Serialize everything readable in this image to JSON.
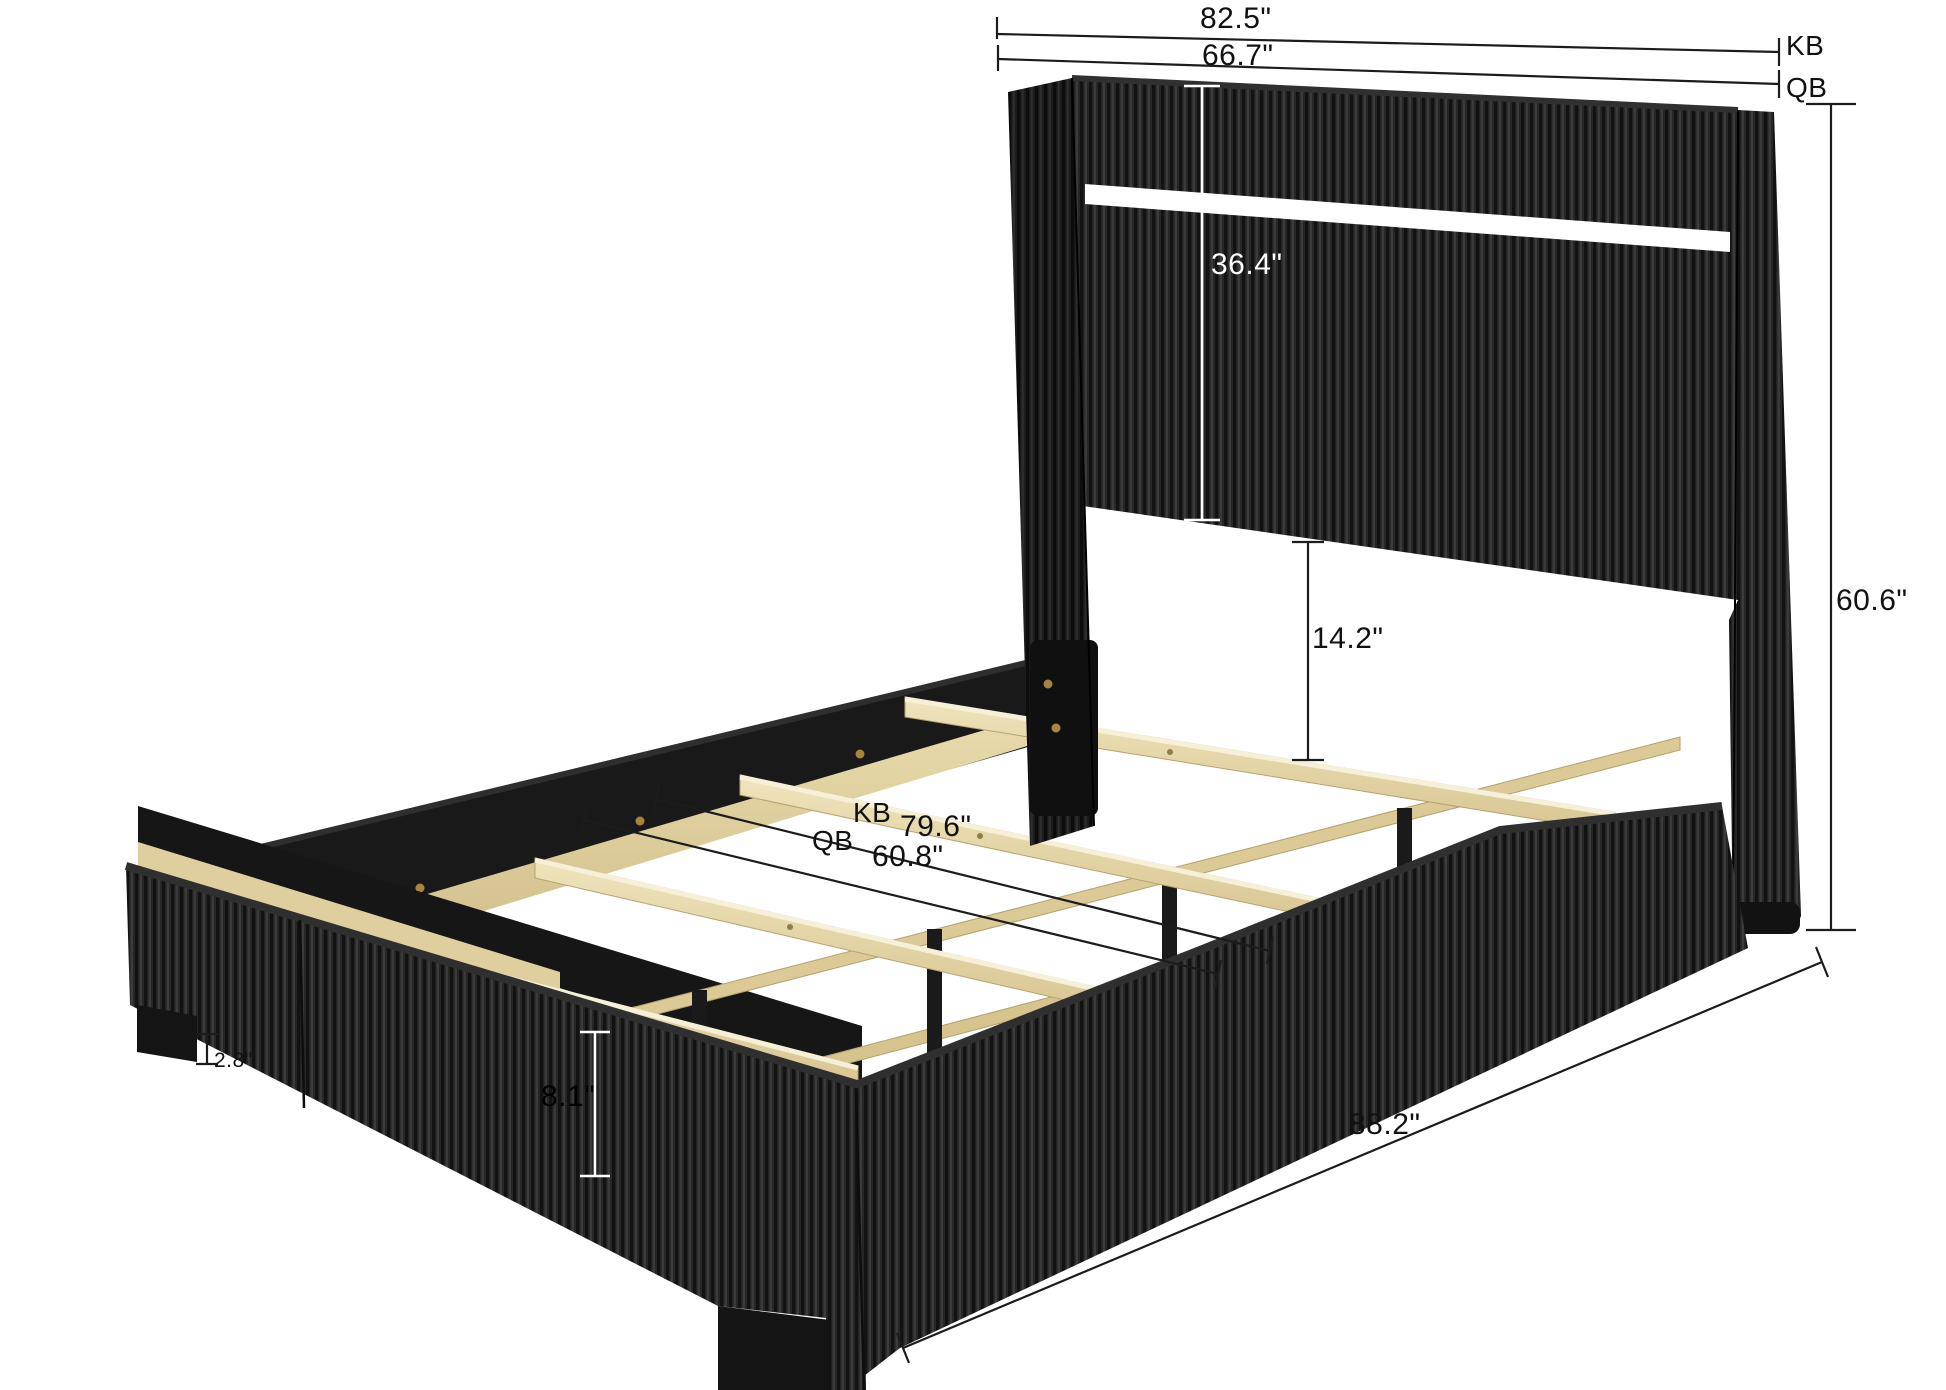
{
  "diagram": {
    "background": "#ffffff",
    "dimension_labels": {
      "king_headboard_width": "82.5\"",
      "king_tag_top": "KB",
      "queen_headboard_width": "66.7\"",
      "queen_tag_top": "QB",
      "headboard_panel_height": "36.4\"",
      "headboard_to_slat_clearance": "14.2\"",
      "king_tag_interior": "KB",
      "king_interior_width": "79.6\"",
      "queen_tag_interior": "QB",
      "queen_interior_width": "60.8\"",
      "side_rail_height": "8.1\"",
      "leg_height": "2.8\"",
      "overall_length": "88.2\"",
      "overall_height": "60.6\""
    },
    "colors": {
      "fabric": "#262626",
      "fabric_dark": "#1b1b1b",
      "fabric_piping": "#2f2f2f",
      "rail_inner": "#191919",
      "wood": "#e7d8a8",
      "wood_dark": "#d9c68e",
      "led_strip": "#ffffff",
      "dimension_line": "#1c1c1c",
      "screw_gold": "#a8853c"
    }
  }
}
